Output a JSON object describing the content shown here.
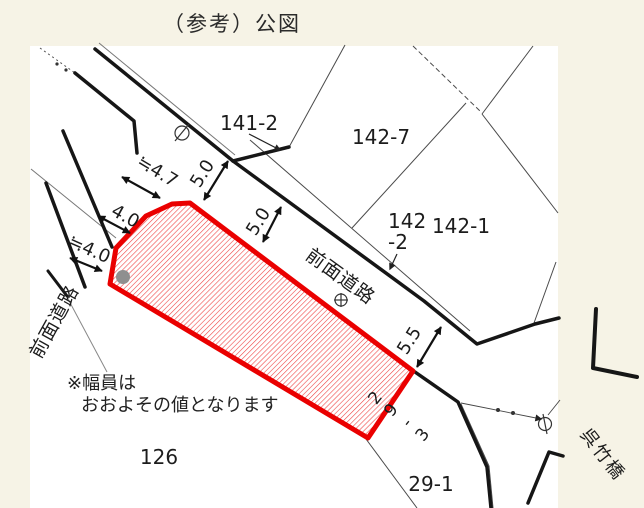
{
  "page": {
    "title": "（参考）公図"
  },
  "colors": {
    "outline_red": "#ea0000",
    "hatch_red": "#ef4040",
    "road_line": "#161616",
    "gray_dot": "#8f8f8f",
    "paper": "#ffffff",
    "background": "#f6f3e6"
  },
  "labels": {
    "road_left": "前面道路",
    "road_main": "前面道路",
    "bridge": "呉竹橋",
    "p141_2": "141-2",
    "p142_7": "142-7",
    "p142_1": "142-1",
    "p142_2_line1": "142",
    "p142_2_line2": "-2",
    "p126": "126",
    "p29_1": "29-1",
    "p29_3": "29-3"
  },
  "dimensions": {
    "left_road_top": "≒4.7",
    "left_road_mid": "4.0",
    "left_road_bottom": "≒4.0",
    "main_road_upper": "5.0",
    "main_road_mid": "5.0",
    "main_road_lower": "5.5"
  },
  "note": {
    "line1": "※幅員は",
    "line2": "おおよその値となります"
  }
}
